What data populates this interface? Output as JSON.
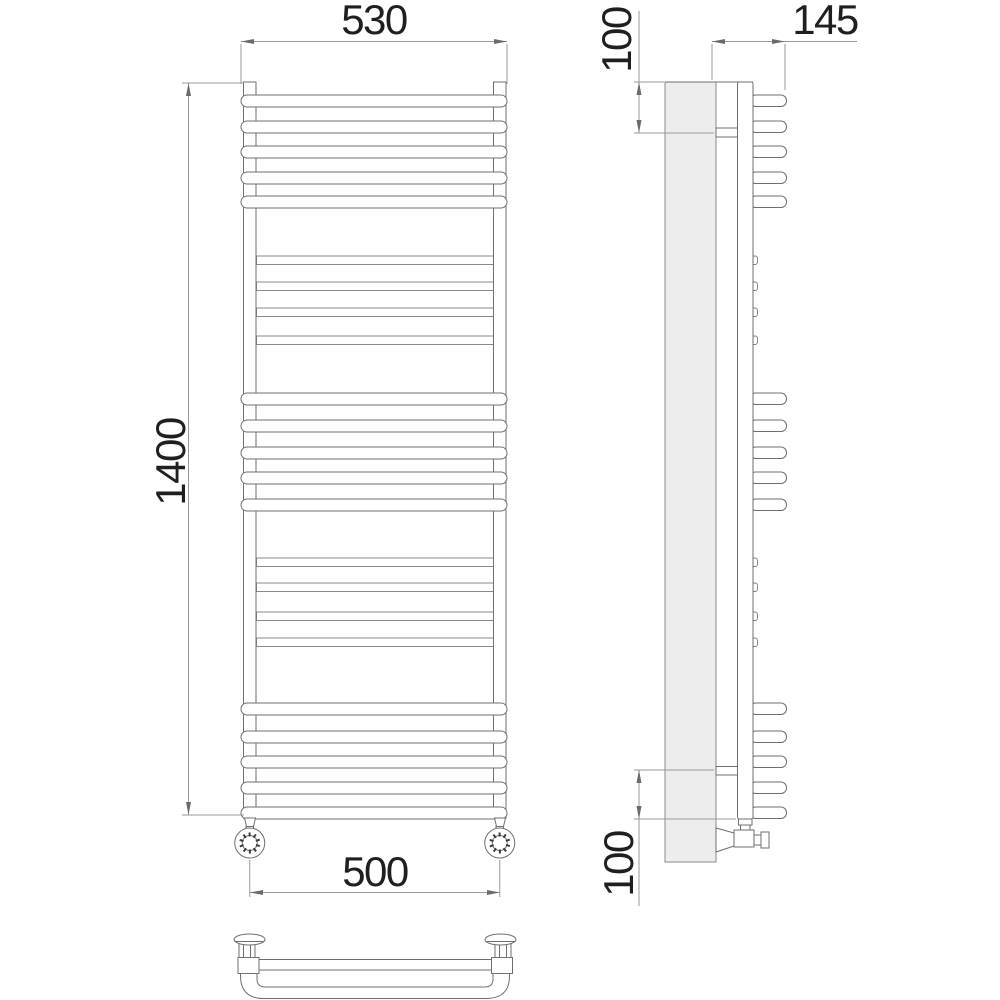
{
  "dimensions": {
    "bar_width": "530",
    "overall_height": "1400",
    "connection_spacing": "500",
    "depth": "145",
    "top_bracket_offset": "100",
    "bottom_bracket_offset": "100"
  },
  "structure": {
    "wide_bar_groups": [
      5,
      5,
      5
    ],
    "thin_bar_groups": [
      4,
      4
    ],
    "views": [
      "front",
      "side",
      "bottom"
    ]
  },
  "colors": {
    "outline": "#6f6f6f",
    "dimension_line": "#9a9a9a",
    "text": "#1f1f1f",
    "wall_fill": "#ededed",
    "background": "#ffffff"
  }
}
